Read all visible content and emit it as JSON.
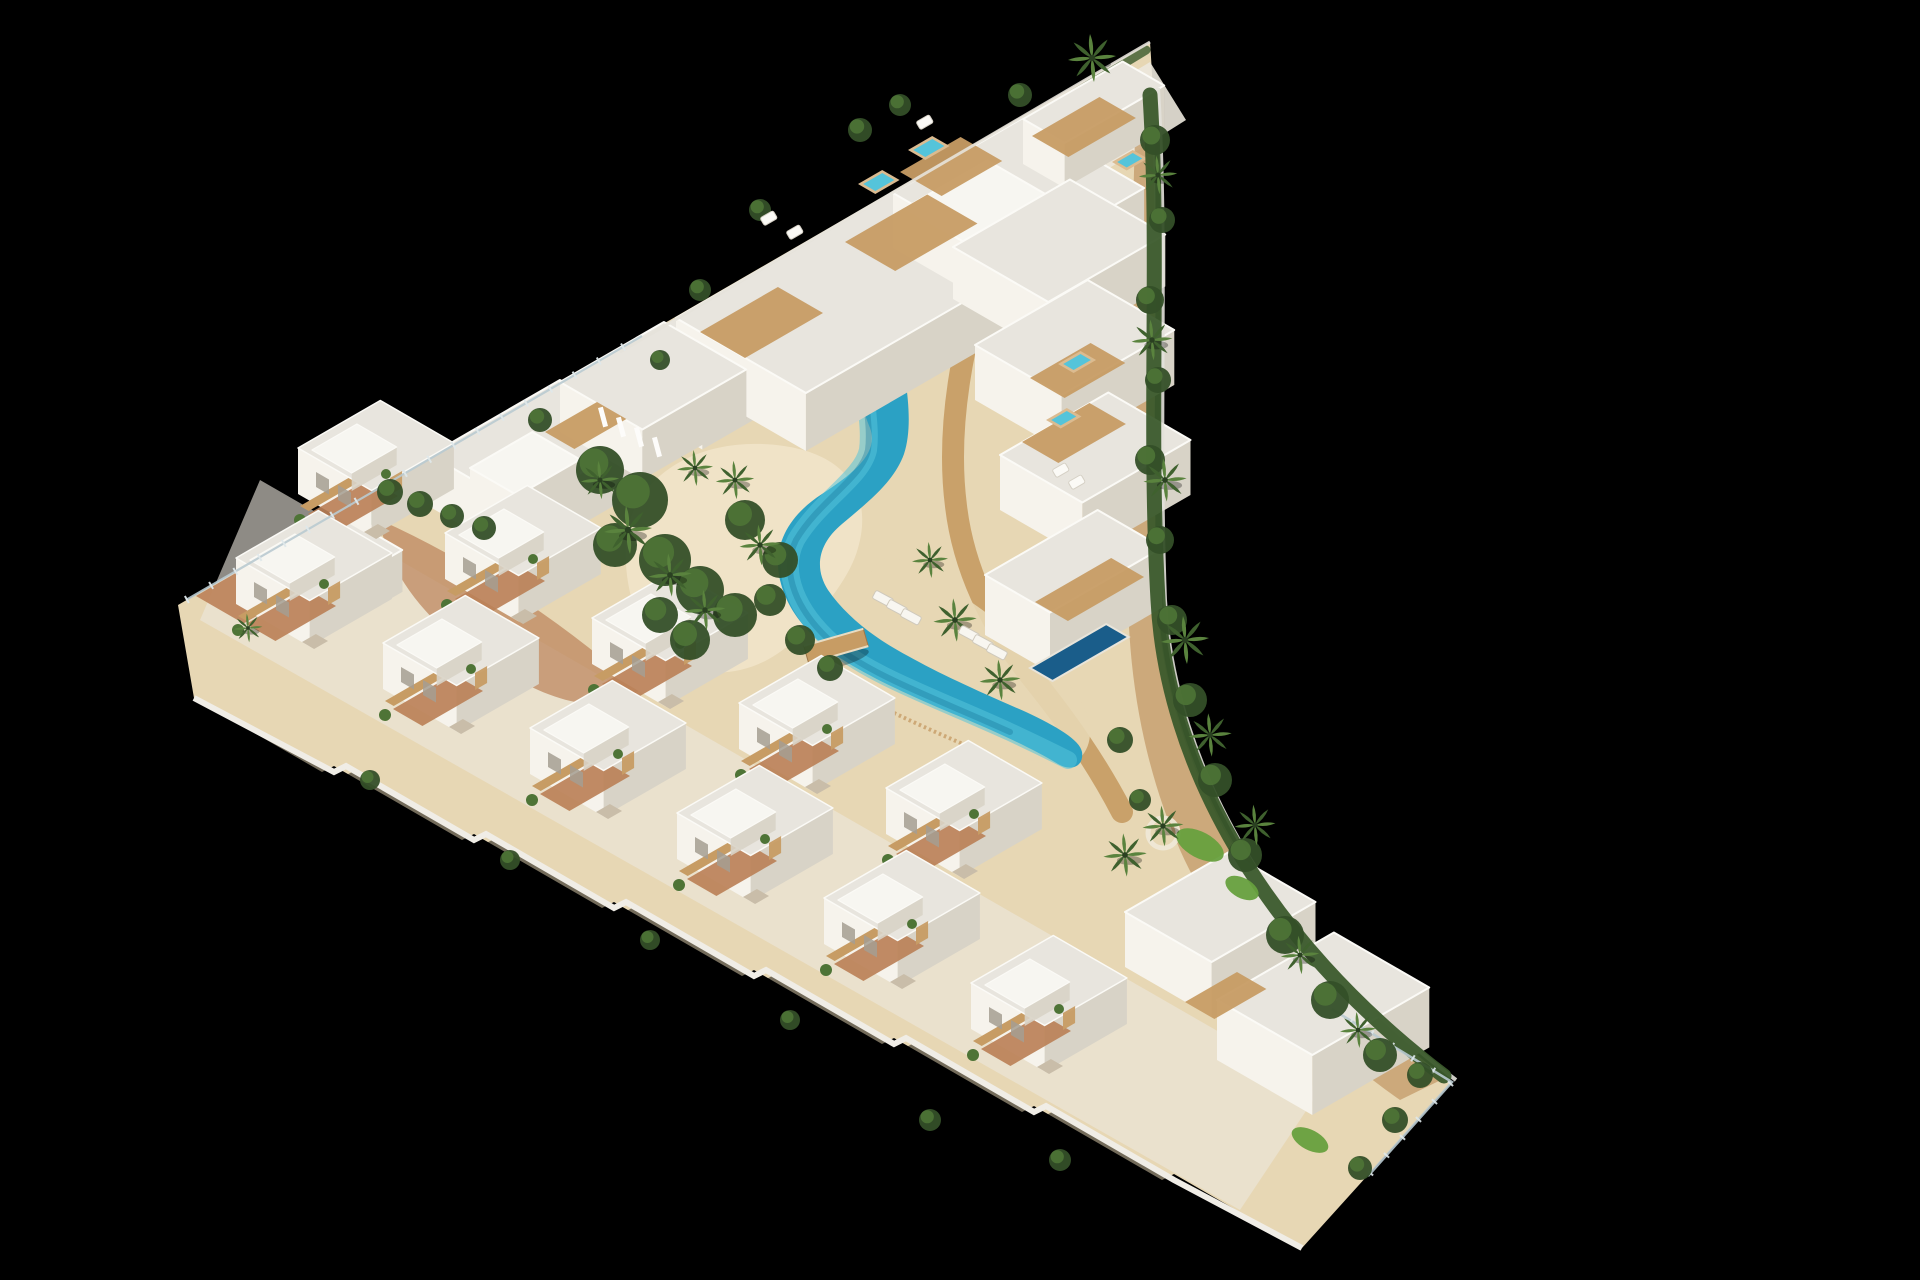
{
  "scene": {
    "title": "aerial-3d-architectural-render",
    "description": "Isometric aerial 3D rendering of a white Mediterranean residential resort complex on a triangular plot against a black background: a multi-storey apartment block with rooftop jacuzzis along the top edge, staggered rows of white townhouses with wooden pergolas along the bottom edge, stepped villas with roof terraces on the right, a turquoise lagoon-style pool with sandy beaches, a wooden bridge, curved boardwalks, palm trees, hedges and gardens.",
    "background_color": "#000000",
    "counts": {
      "apartment_slabs": 4,
      "townhouses_upper_row": 5,
      "townhouses_lower_row": 6,
      "right_side_villas": 4,
      "bottom_right_villas": 2,
      "rooftop_jacuzzis": 5,
      "private_pools": 1,
      "lagoon_pools": 1,
      "bridges": 1,
      "palm_trees": 22
    }
  },
  "palette": {
    "bg": "#000000",
    "wallLight": "#f6f3ec",
    "wallShade": "#d8d3c7",
    "wallDark": "#c2bcb0",
    "roof": "#e8e5de",
    "roofBright": "#f7f6f1",
    "parapet": "#fbfaf6",
    "concrete": "#ece8dd",
    "sand": "#e7d7b4",
    "sandLight": "#f0e4c8",
    "clay": "#bb8158",
    "dirt": "#c39a68",
    "wood": "#c79c64",
    "woodLight": "#dbbb90",
    "poolLight": "#55c4da",
    "poolMid": "#2ba1c4",
    "poolDeep": "#147499",
    "poolPrivate": "#1a5d8a",
    "green": "#4e7436",
    "greenDark": "#344f28",
    "palm": "#5a833e",
    "palmDark": "#3f612e",
    "grass": "#67a03e",
    "hedge": "#3b5a2c",
    "glass": "#b9cad0",
    "stone": "#c9bda9"
  },
  "scene_objects": {
    "blocks": [
      {
        "name": "apartment-slab-west",
        "x": 620,
        "y": 352,
        "a": 160,
        "b": 95,
        "h": 50
      },
      {
        "name": "apartment-slab-mid",
        "x": 676,
        "y": 318,
        "a": 250,
        "b": 150,
        "h": 58
      },
      {
        "name": "apartment-slab-east",
        "x": 893,
        "y": 193,
        "a": 150,
        "b": 140,
        "h": 55
      },
      {
        "name": "apartment-tip",
        "x": 1023,
        "y": 119,
        "a": 115,
        "b": 48,
        "h": 45
      },
      {
        "name": "penthouse-roof-deck",
        "x": 905,
        "y": 208,
        "a": 95,
        "b": 70,
        "h": 0,
        "bright": true
      },
      {
        "name": "villa-vertex",
        "x": 255,
        "y": 560,
        "a": 95,
        "b": 75,
        "h": 42
      },
      {
        "name": "villa-mid-left-a",
        "x": 430,
        "y": 455,
        "a": 150,
        "b": 105,
        "h": 52
      },
      {
        "name": "villa-mid-left-b",
        "x": 560,
        "y": 382,
        "a": 120,
        "b": 95,
        "h": 50
      },
      {
        "name": "villa-mid-left-top",
        "x": 470,
        "y": 468,
        "a": 72,
        "b": 55,
        "h": 30,
        "bright": true
      },
      {
        "name": "villa-right-1",
        "x": 953,
        "y": 247,
        "a": 135,
        "b": 110,
        "h": 52
      },
      {
        "name": "villa-right-2",
        "x": 975,
        "y": 345,
        "a": 130,
        "b": 100,
        "h": 55
      },
      {
        "name": "villa-right-3",
        "x": 1000,
        "y": 455,
        "a": 125,
        "b": 95,
        "h": 55
      },
      {
        "name": "villa-right-4",
        "x": 985,
        "y": 575,
        "a": 130,
        "b": 75,
        "h": 60
      },
      {
        "name": "villa-bottom-right-1",
        "x": 1125,
        "y": 912,
        "a": 120,
        "b": 100,
        "h": 55
      },
      {
        "name": "villa-bottom-right-2",
        "x": 1217,
        "y": 1000,
        "a": 135,
        "b": 110,
        "h": 60
      }
    ],
    "roof_decks": [
      {
        "x": 700,
        "y": 332,
        "a": 90,
        "b": 52
      },
      {
        "x": 845,
        "y": 242,
        "a": 95,
        "b": 58
      },
      {
        "x": 900,
        "y": 172,
        "a": 70,
        "b": 48
      },
      {
        "x": 1032,
        "y": 136,
        "a": 78,
        "b": 42
      },
      {
        "x": 1030,
        "y": 378,
        "a": 70,
        "b": 40
      },
      {
        "x": 1022,
        "y": 442,
        "a": 78,
        "b": 42
      },
      {
        "x": 1035,
        "y": 602,
        "a": 88,
        "b": 38
      },
      {
        "x": 1185,
        "y": 1002,
        "a": 60,
        "b": 34
      },
      {
        "x": 545,
        "y": 432,
        "a": 60,
        "b": 34
      }
    ],
    "jacuzzis": [
      {
        "x": 858,
        "y": 184,
        "a": 28,
        "b": 20
      },
      {
        "x": 908,
        "y": 150,
        "a": 28,
        "b": 20
      },
      {
        "x": 1112,
        "y": 162,
        "a": 24,
        "b": 17
      },
      {
        "x": 1058,
        "y": 364,
        "a": 26,
        "b": 18
      },
      {
        "x": 1046,
        "y": 420,
        "a": 24,
        "b": 17
      }
    ],
    "private_pool": {
      "x": 1030,
      "y": 668,
      "a": 88,
      "b": 26
    },
    "townhouses_upper_row": [
      [
        298,
        448
      ],
      [
        445,
        533
      ],
      [
        592,
        618
      ],
      [
        739,
        703
      ],
      [
        886,
        788
      ]
    ],
    "townhouses_lower_row": [
      [
        236,
        558
      ],
      [
        383,
        643
      ],
      [
        530,
        728
      ],
      [
        677,
        813
      ],
      [
        824,
        898
      ],
      [
        971,
        983
      ]
    ],
    "palms": [
      [
        1092,
        58,
        1
      ],
      [
        628,
        530,
        1
      ],
      [
        670,
        575,
        0.9
      ],
      [
        705,
        610,
        0.85
      ],
      [
        600,
        480,
        0.8
      ],
      [
        735,
        480,
        0.8
      ],
      [
        760,
        545,
        0.85
      ],
      [
        695,
        468,
        0.75
      ],
      [
        955,
        620,
        0.9
      ],
      [
        1000,
        680,
        0.85
      ],
      [
        930,
        560,
        0.75
      ],
      [
        1158,
        175,
        0.8
      ],
      [
        1152,
        340,
        0.85
      ],
      [
        1165,
        480,
        0.9
      ],
      [
        1185,
        640,
        1
      ],
      [
        1210,
        735,
        0.9
      ],
      [
        1255,
        825,
        0.85
      ],
      [
        1300,
        955,
        0.8
      ],
      [
        1358,
        1030,
        0.75
      ],
      [
        1163,
        826,
        0.85
      ],
      [
        1125,
        855,
        0.9
      ],
      [
        248,
        628,
        0.6
      ]
    ],
    "shrubs": [
      [
        390,
        492,
        13
      ],
      [
        420,
        504,
        13
      ],
      [
        452,
        516,
        12
      ],
      [
        484,
        528,
        12
      ],
      [
        600,
        470,
        24
      ],
      [
        640,
        500,
        28
      ],
      [
        615,
        545,
        22
      ],
      [
        665,
        560,
        26
      ],
      [
        700,
        590,
        24
      ],
      [
        735,
        615,
        22
      ],
      [
        690,
        640,
        20
      ],
      [
        660,
        615,
        18
      ],
      [
        745,
        520,
        20
      ],
      [
        780,
        560,
        18
      ],
      [
        770,
        600,
        16
      ],
      [
        800,
        640,
        15
      ],
      [
        830,
        668,
        13
      ],
      [
        1155,
        140,
        15
      ],
      [
        1162,
        220,
        13
      ],
      [
        1150,
        300,
        14
      ],
      [
        1158,
        380,
        13
      ],
      [
        1150,
        460,
        15
      ],
      [
        1160,
        540,
        14
      ],
      [
        1172,
        620,
        15
      ],
      [
        1190,
        700,
        17
      ],
      [
        1215,
        780,
        17
      ],
      [
        1245,
        855,
        17
      ],
      [
        1285,
        935,
        19
      ],
      [
        1330,
        1000,
        19
      ],
      [
        1380,
        1055,
        17
      ],
      [
        1420,
        1075,
        13
      ],
      [
        1395,
        1120,
        13
      ],
      [
        1360,
        1168,
        12
      ],
      [
        1120,
        740,
        13
      ],
      [
        1140,
        800,
        11
      ],
      [
        860,
        130,
        12
      ],
      [
        900,
        105,
        11
      ],
      [
        1020,
        95,
        12
      ],
      [
        760,
        210,
        11
      ],
      [
        700,
        290,
        11
      ],
      [
        540,
        420,
        12
      ],
      [
        660,
        360,
        10
      ],
      [
        930,
        1120,
        11
      ],
      [
        1060,
        1160,
        11
      ],
      [
        790,
        1020,
        10
      ],
      [
        650,
        940,
        10
      ],
      [
        510,
        860,
        10
      ],
      [
        370,
        780,
        10
      ]
    ],
    "grass_patches": [
      [
        1200,
        845,
        26,
        13
      ],
      [
        1242,
        888,
        18,
        10
      ],
      [
        1310,
        1140,
        20,
        10
      ]
    ],
    "sun_loungers": [
      [
        872,
        598
      ],
      [
        886,
        607
      ],
      [
        900,
        616
      ],
      [
        958,
        633
      ],
      [
        972,
        642
      ],
      [
        986,
        651
      ]
    ],
    "roof_furniture": [
      [
        760,
        218
      ],
      [
        786,
        232
      ],
      [
        916,
        122
      ],
      [
        1052,
        470
      ],
      [
        1068,
        482
      ]
    ],
    "arch_columns": [
      [
        598,
        408
      ],
      [
        616,
        418
      ],
      [
        634,
        428
      ],
      [
        652,
        438
      ]
    ],
    "bridge": {
      "x": 836,
      "y": 646,
      "angle": -16,
      "w": 62,
      "h": 18
    }
  }
}
